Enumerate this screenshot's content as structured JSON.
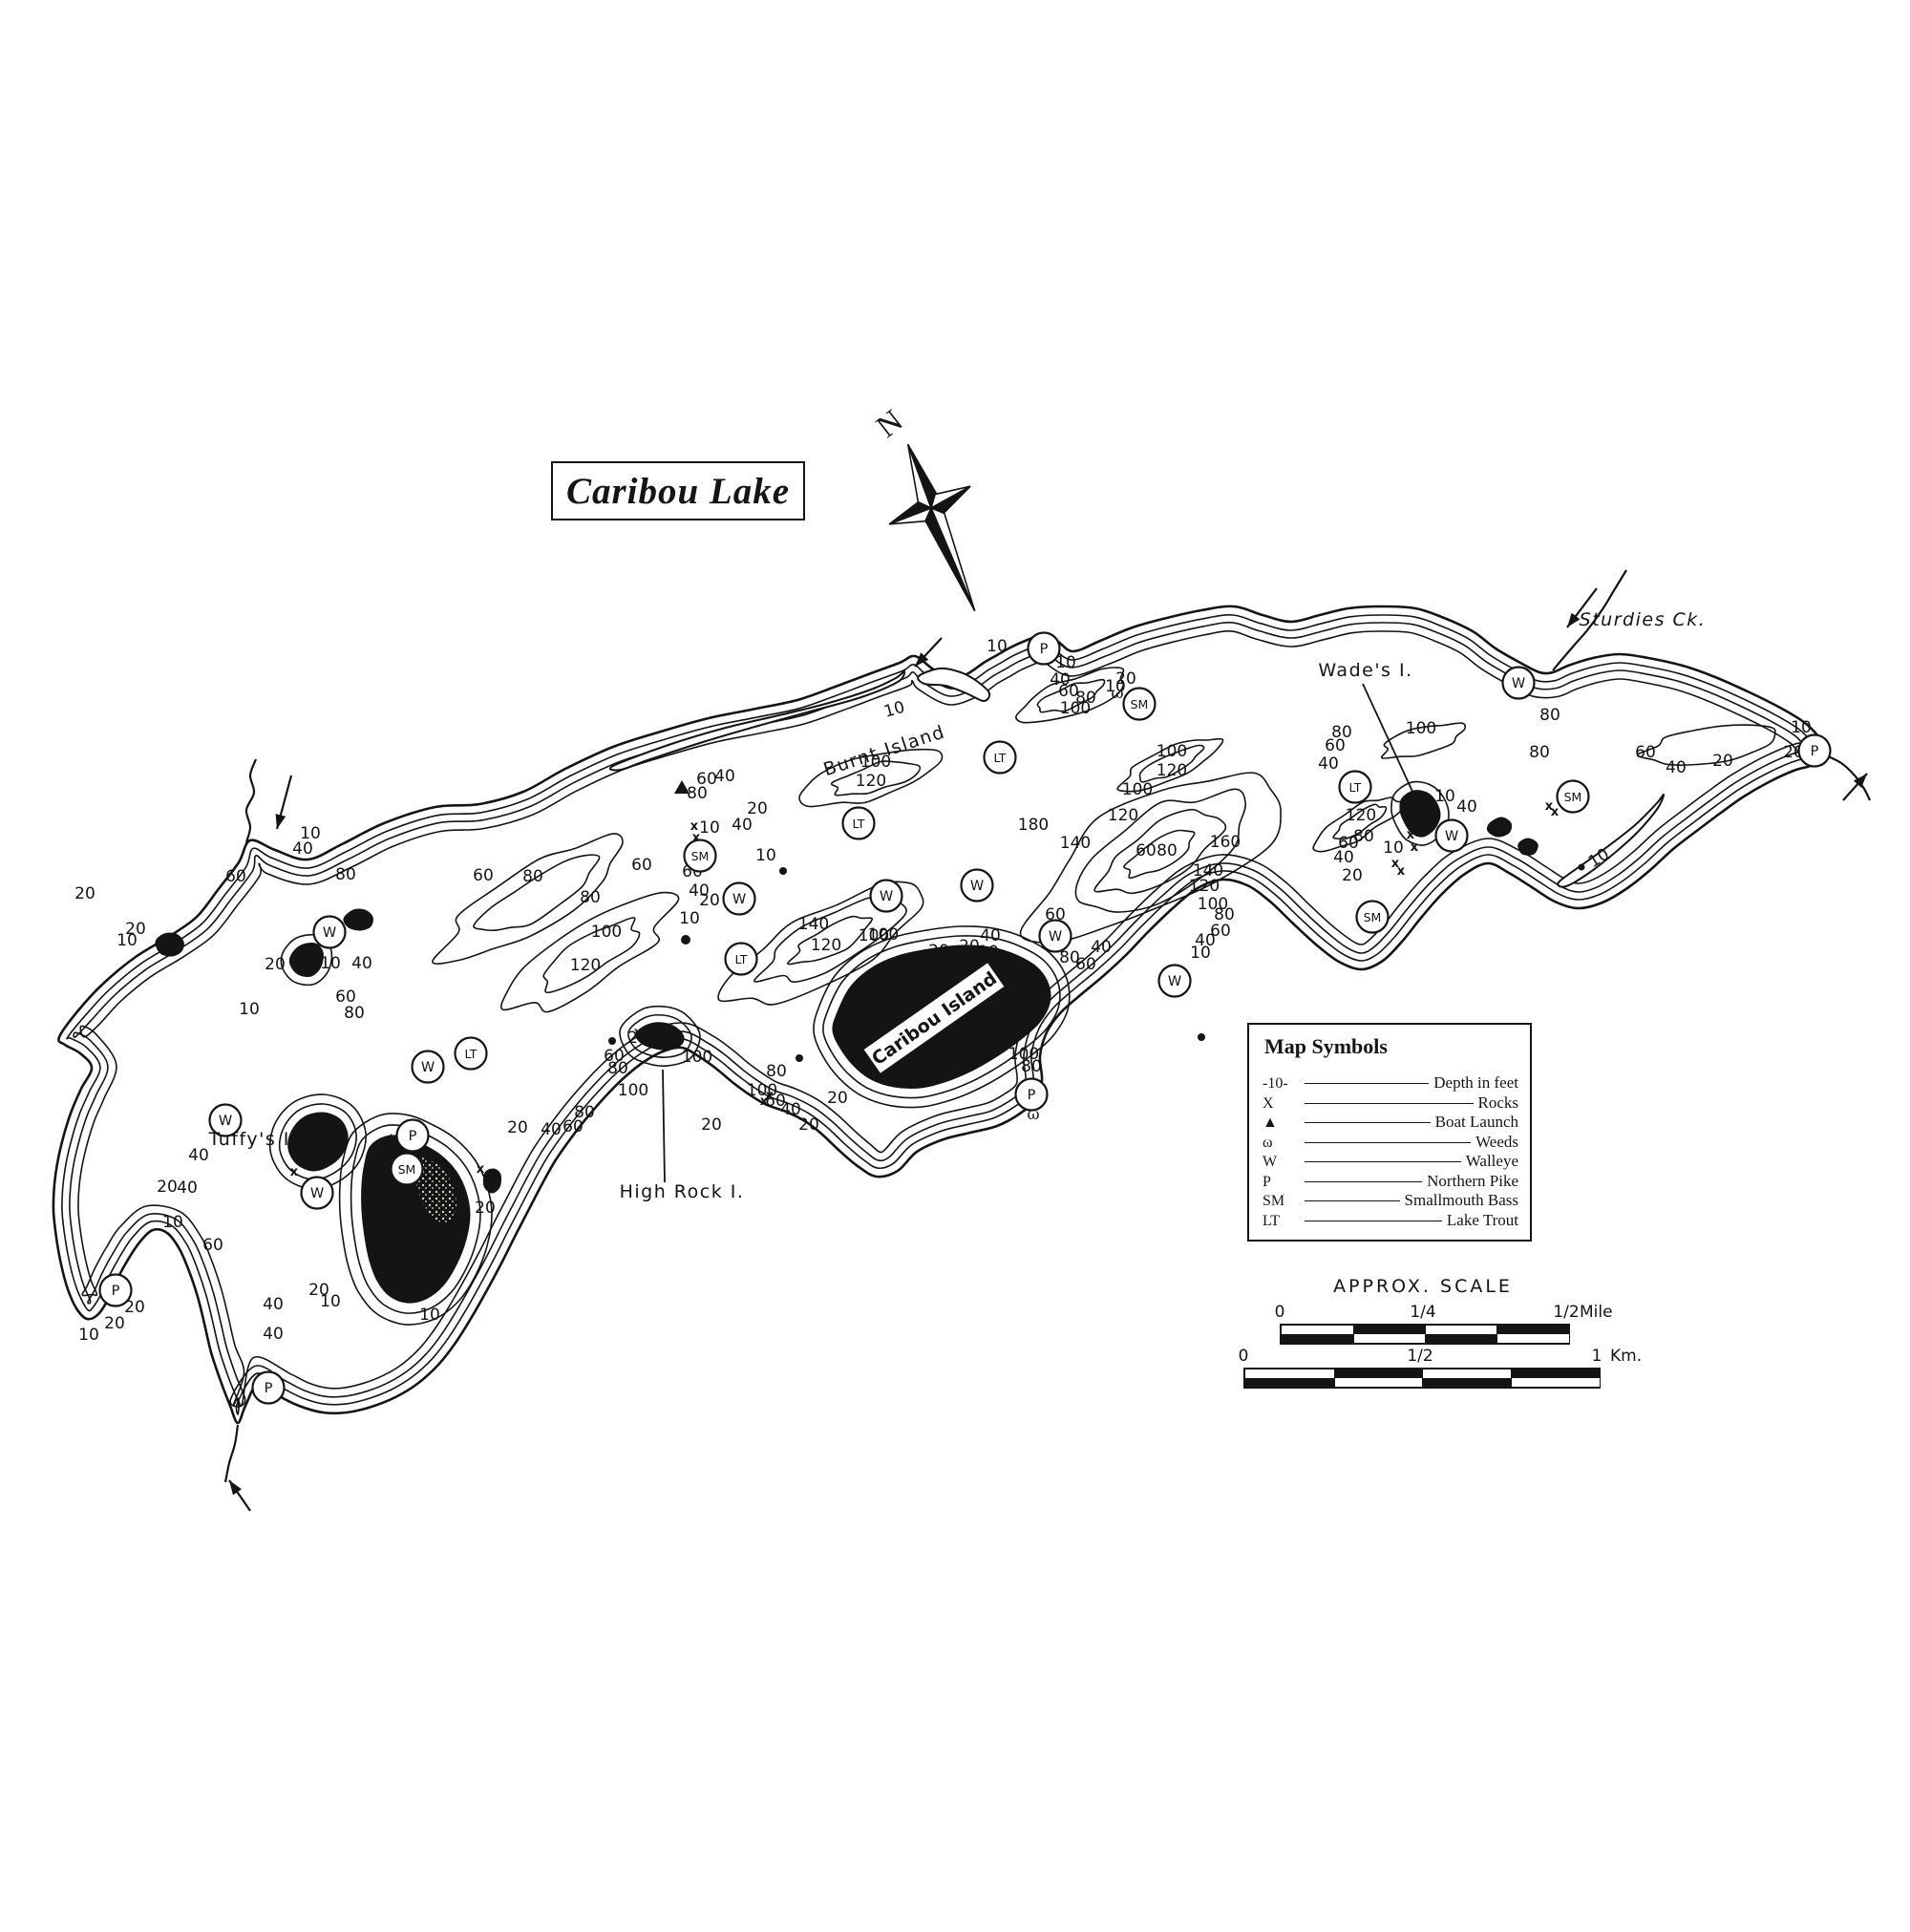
{
  "title": "Caribou Lake",
  "north_label": "N",
  "colors": {
    "ink": "#141414",
    "paper": "#ffffff"
  },
  "legend": {
    "title": "Map Symbols",
    "rows": [
      {
        "symbol": "-10-",
        "label": "Depth in feet"
      },
      {
        "symbol": "X",
        "label": "Rocks"
      },
      {
        "symbol": "▲",
        "label": "Boat Launch"
      },
      {
        "symbol": "ω",
        "label": "Weeds"
      },
      {
        "symbol": "W",
        "label": "Walleye"
      },
      {
        "symbol": "P",
        "label": "Northern Pike"
      },
      {
        "symbol": "SM",
        "label": "Smallmouth Bass"
      },
      {
        "symbol": "LT",
        "label": "Lake Trout"
      }
    ]
  },
  "scale": {
    "title": "APPROX. SCALE",
    "mile": {
      "ticks": [
        "0",
        "1/4",
        "1/2"
      ],
      "unit": "Mile"
    },
    "km": {
      "ticks": [
        "0",
        "1/2",
        "1"
      ],
      "unit": "Km."
    }
  },
  "labels": {
    "burnt": "Burnt Island",
    "caribou": "Caribou Island",
    "tuffys": "Tuffy's I.",
    "highrock": "High Rock I.",
    "wades": "Wade's I.",
    "sturdies": "Sturdies Ck."
  },
  "depth_labels": [
    [
      20,
      89,
      941
    ],
    [
      20,
      142,
      978
    ],
    [
      10,
      133,
      990
    ],
    [
      60,
      247,
      923
    ],
    [
      10,
      325,
      878
    ],
    [
      40,
      317,
      894
    ],
    [
      80,
      362,
      921
    ],
    [
      20,
      288,
      1015
    ],
    [
      10,
      346,
      1014
    ],
    [
      40,
      379,
      1014
    ],
    [
      60,
      362,
      1049
    ],
    [
      80,
      371,
      1066
    ],
    [
      10,
      261,
      1062
    ],
    [
      40,
      208,
      1215
    ],
    [
      20,
      175,
      1248
    ],
    [
      40,
      196,
      1249
    ],
    [
      10,
      181,
      1285
    ],
    [
      60,
      223,
      1309
    ],
    [
      20,
      141,
      1374
    ],
    [
      20,
      120,
      1391
    ],
    [
      10,
      93,
      1403
    ],
    [
      40,
      286,
      1371
    ],
    [
      40,
      286,
      1402
    ],
    [
      20,
      334,
      1356
    ],
    [
      10,
      346,
      1368
    ],
    [
      20,
      508,
      1270
    ],
    [
      10,
      450,
      1382
    ],
    [
      10,
      393,
      1223
    ],
    [
      20,
      542,
      1186
    ],
    [
      40,
      577,
      1188
    ],
    [
      60,
      600,
      1185
    ],
    [
      20,
      668,
      1092
    ],
    [
      60,
      643,
      1111
    ],
    [
      80,
      647,
      1124
    ],
    [
      100,
      663,
      1147
    ],
    [
      80,
      612,
      1170
    ],
    [
      100,
      730,
      1112
    ],
    [
      80,
      813,
      1127
    ],
    [
      100,
      798,
      1147
    ],
    [
      60,
      812,
      1158
    ],
    [
      40,
      828,
      1167
    ],
    [
      20,
      847,
      1183
    ],
    [
      20,
      745,
      1183
    ],
    [
      60,
      506,
      922
    ],
    [
      80,
      558,
      923
    ],
    [
      80,
      618,
      945
    ],
    [
      60,
      672,
      911
    ],
    [
      100,
      635,
      981
    ],
    [
      120,
      613,
      1016
    ],
    [
      60,
      740,
      821
    ],
    [
      80,
      730,
      836
    ],
    [
      40,
      759,
      818
    ],
    [
      20,
      793,
      852
    ],
    [
      40,
      777,
      869
    ],
    [
      10,
      743,
      872
    ],
    [
      10,
      802,
      901
    ],
    [
      60,
      725,
      918
    ],
    [
      40,
      732,
      938
    ],
    [
      20,
      743,
      948
    ],
    [
      10,
      722,
      967
    ],
    [
      140,
      852,
      973
    ],
    [
      120,
      865,
      995
    ],
    [
      100,
      915,
      985
    ],
    [
      100,
      917,
      803
    ],
    [
      120,
      912,
      823
    ],
    [
      180,
      1082,
      869
    ],
    [
      40,
      1037,
      985
    ],
    [
      20,
      1015,
      996
    ],
    [
      10,
      1035,
      1002
    ],
    [
      10,
      1044,
      682
    ],
    [
      10,
      938,
      748,
      -16
    ],
    [
      10,
      1116,
      699
    ],
    [
      40,
      1110,
      717
    ],
    [
      60,
      1119,
      729
    ],
    [
      80,
      1137,
      736
    ],
    [
      100,
      1126,
      747
    ],
    [
      20,
      1179,
      716
    ],
    [
      10,
      1168,
      724
    ],
    [
      100,
      1227,
      792
    ],
    [
      120,
      1227,
      812
    ],
    [
      100,
      1191,
      832
    ],
    [
      120,
      1176,
      859
    ],
    [
      140,
      1126,
      888
    ],
    [
      160,
      1283,
      887
    ],
    [
      140,
      1265,
      917
    ],
    [
      120,
      1261,
      933
    ],
    [
      60,
      1200,
      896
    ],
    [
      80,
      1222,
      896
    ],
    [
      80,
      1405,
      772
    ],
    [
      60,
      1398,
      786
    ],
    [
      40,
      1391,
      805
    ],
    [
      120,
      1425,
      859
    ],
    [
      80,
      1428,
      881
    ],
    [
      60,
      1412,
      888
    ],
    [
      40,
      1407,
      903
    ],
    [
      20,
      1416,
      922
    ],
    [
      10,
      1459,
      893
    ],
    [
      10,
      1513,
      839
    ],
    [
      40,
      1536,
      850
    ],
    [
      100,
      1488,
      768
    ],
    [
      80,
      1623,
      754
    ],
    [
      80,
      1612,
      793
    ],
    [
      60,
      1723,
      793
    ],
    [
      40,
      1755,
      809
    ],
    [
      20,
      1804,
      802
    ],
    [
      20,
      1878,
      793
    ],
    [
      10,
      1886,
      767
    ],
    [
      10,
      1677,
      903,
      -32
    ],
    [
      100,
      1072,
      1109
    ],
    [
      80,
      1080,
      1122
    ],
    [
      10,
      1082,
      1161
    ],
    [
      20,
      877,
      1155
    ],
    [
      60,
      1105,
      963
    ],
    [
      40,
      1153,
      997
    ],
    [
      80,
      1120,
      1008
    ],
    [
      60,
      1137,
      1015
    ],
    [
      100,
      925,
      984
    ],
    [
      20,
      983,
      1001
    ],
    [
      80,
      1282,
      963
    ],
    [
      60,
      1278,
      980
    ],
    [
      40,
      1262,
      990
    ],
    [
      10,
      1257,
      1003
    ],
    [
      100,
      1270,
      952
    ]
  ],
  "fish_symbols": [
    [
      "P",
      1093,
      679
    ],
    [
      "SM",
      1193,
      737
    ],
    [
      "LT",
      1047,
      793
    ],
    [
      "LT",
      899,
      862
    ],
    [
      "SM",
      733,
      896
    ],
    [
      "W",
      774,
      941
    ],
    [
      "W",
      928,
      938
    ],
    [
      "W",
      1023,
      927
    ],
    [
      "LT",
      776,
      1004
    ],
    [
      "W",
      1105,
      980
    ],
    [
      "W",
      1230,
      1027
    ],
    [
      "P",
      1080,
      1146
    ],
    [
      "W",
      345,
      976
    ],
    [
      "LT",
      493,
      1103
    ],
    [
      "W",
      448,
      1117
    ],
    [
      "P",
      432,
      1189
    ],
    [
      "SM",
      426,
      1224
    ],
    [
      "W",
      236,
      1173
    ],
    [
      "W",
      332,
      1249
    ],
    [
      "P",
      121,
      1351
    ],
    [
      "P",
      281,
      1453
    ],
    [
      "LT",
      1419,
      824
    ],
    [
      "W",
      1590,
      715
    ],
    [
      "SM",
      1647,
      834
    ],
    [
      "W",
      1520,
      875
    ],
    [
      "SM",
      1437,
      960
    ],
    [
      "P",
      1900,
      786
    ]
  ],
  "rocks": [
    [
      727,
      869
    ],
    [
      729,
      881
    ],
    [
      308,
      1231
    ],
    [
      503,
      1228
    ],
    [
      668,
      1085
    ],
    [
      800,
      1157
    ],
    [
      806,
      1151
    ],
    [
      1477,
      878
    ],
    [
      1481,
      891
    ],
    [
      1461,
      908
    ],
    [
      1467,
      916
    ],
    [
      1622,
      848
    ],
    [
      1628,
      854
    ],
    [
      1060,
      1056
    ]
  ],
  "weeds": [
    [
      413,
      1196
    ],
    [
      1082,
      1172
    ],
    [
      1170,
      731
    ]
  ],
  "boat_launch": [
    [
      714,
      827
    ]
  ]
}
